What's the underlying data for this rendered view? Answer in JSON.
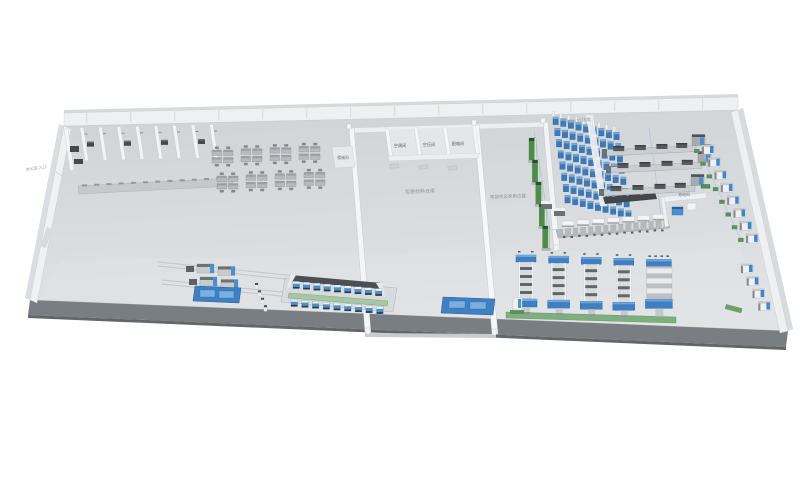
{
  "labels": {
    "entrance": "办公区入口",
    "asrs": "自动化立体库",
    "rooms": [
      "空调间",
      "空压间",
      "配电间"
    ],
    "stair": "楼梯间",
    "hall_left": "包装材料仓库",
    "hall_right": "零部件及充电位置",
    "charge": "充电间"
  },
  "palette": {
    "floor_top": "#d6d9dc",
    "floor_face": "#797e82",
    "wall": "#eef0f1",
    "wall_shade": "#d8dbde",
    "blue": "#3f7fc4",
    "blue_light": "#79afe0",
    "blue_dark": "#2c5e93",
    "machine_blue": "#4a8fd0",
    "rack_blue": "#3b79ba",
    "green": "#4f8c4c",
    "green_strip": "#7db07d",
    "green_pad": "#5b9158",
    "dark": "#4a4e52",
    "metal": "#c9ccce",
    "desk": "#b7babd",
    "label_gray": "#9aa0a5"
  },
  "scene": {
    "rack": {
      "cols": 9,
      "rows": 8
    },
    "green_towers": 5,
    "desk_clusters": {
      "rows": 2,
      "cols": 4
    },
    "office_partitions": 8,
    "corridor_dashes": 12,
    "back_wall_ticks": 15,
    "production_lines": 3,
    "wall_machines_upper": 8,
    "wall_machines_lower": 4,
    "dock_stations": 7,
    "vertical_lines": 5,
    "assembly_stations_per_row": 9
  }
}
